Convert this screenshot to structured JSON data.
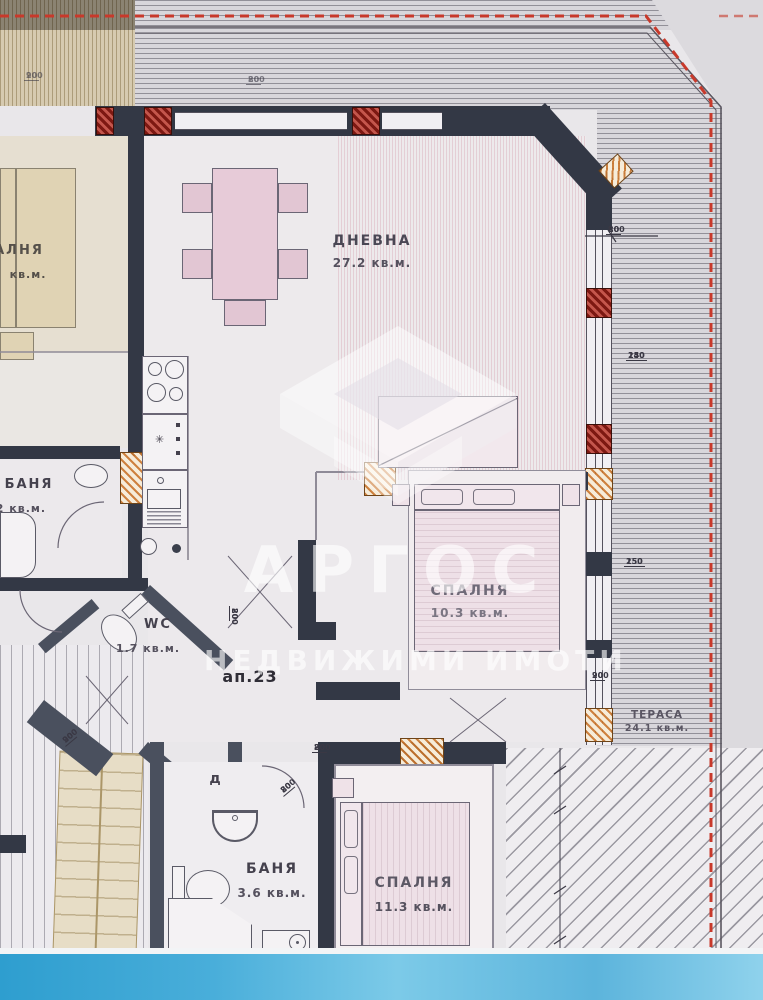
{
  "watermark": {
    "brand": "АРГОС",
    "tagline": "НЕДВИЖИМИ ИМОТИ"
  },
  "apartment": {
    "unit_label": "ап.23",
    "door_label": "д"
  },
  "rooms": {
    "living": {
      "name": "ДНЕВНА",
      "area": "27.2 кв.м."
    },
    "bedroom1": {
      "name": "СПАЛНЯ",
      "area": "10.3 кв.м."
    },
    "bedroom2": {
      "name": "СПАЛНЯ",
      "area": "11.3 кв.м."
    },
    "bath": {
      "name": "БАНЯ",
      "area": "3.6 кв.м."
    },
    "wc": {
      "name": "WC",
      "area": "1.7 кв.м."
    },
    "bath_left": {
      "name": "БАНЯ",
      "area": "4.2 кв.м."
    },
    "terrace": {
      "name": "ТЕРАСА",
      "area": "24.1 кв.м."
    },
    "neighbor_bedroom": {
      "name": "АЛНЯ",
      "area": "кв.м."
    }
  },
  "dims": [
    {
      "t": "80",
      "b": "200"
    },
    {
      "t": "140",
      "b": "250"
    },
    {
      "t": "150",
      "b": "250"
    },
    {
      "t": "90",
      "b": "200"
    },
    {
      "t": "80",
      "b": "200"
    },
    {
      "t": "80",
      "b": "200"
    },
    {
      "t": "90",
      "b": "200"
    },
    {
      "t": "80",
      "b": "200"
    },
    {
      "t": "90",
      "b": "200"
    },
    {
      "t": "80",
      "b": "200"
    }
  ],
  "colors": {
    "paper": "#e9e7ea",
    "wall": "#333845",
    "red_line": "#c8392b",
    "blue_band": "#49aeda",
    "tan_terrace": "#d6cab0",
    "watermark": "#ffffff"
  }
}
